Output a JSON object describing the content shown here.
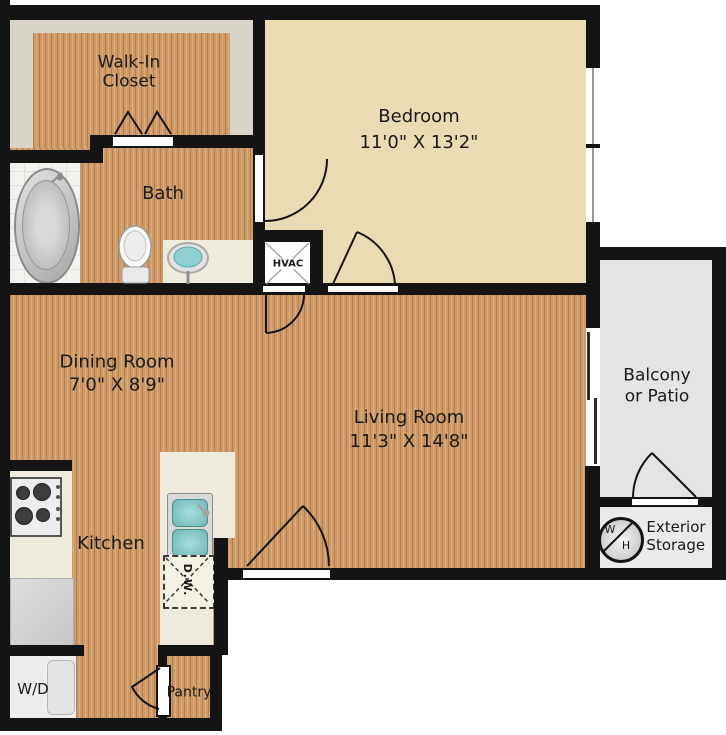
{
  "rooms": {
    "walk_in_closet": {
      "line1": "Walk-In",
      "line2": "Closet"
    },
    "bath": {
      "name": "Bath"
    },
    "bedroom": {
      "name": "Bedroom",
      "dims": "11'0\" X 13'2\""
    },
    "hvac": {
      "label": "HVAC"
    },
    "dining": {
      "name": "Dining Room",
      "dims": "7'0\" X 8'9\""
    },
    "living": {
      "name": "Living Room",
      "dims": "11'3\" X 14'8\""
    },
    "balcony": {
      "line1": "Balcony",
      "line2": "or Patio"
    },
    "exterior_storage": {
      "line1": "Exterior",
      "line2": "Storage"
    },
    "kitchen": {
      "name": "Kitchen"
    },
    "laundry": {
      "label": "W/D"
    },
    "pantry": {
      "label": "Pantry"
    }
  },
  "fixtures": {
    "dishwasher": {
      "label": "D.W."
    },
    "water_heater": {
      "w": "W",
      "h": "H"
    }
  },
  "colors": {
    "wall": "#141414",
    "wood_floor": "#cf9a66",
    "bedroom_floor": "#eadcb2",
    "closet_floor": "#d8d4c8",
    "balcony_floor": "#e4e4e4",
    "counter": "#efebdc",
    "sink_teal": "#7cc5c3"
  }
}
